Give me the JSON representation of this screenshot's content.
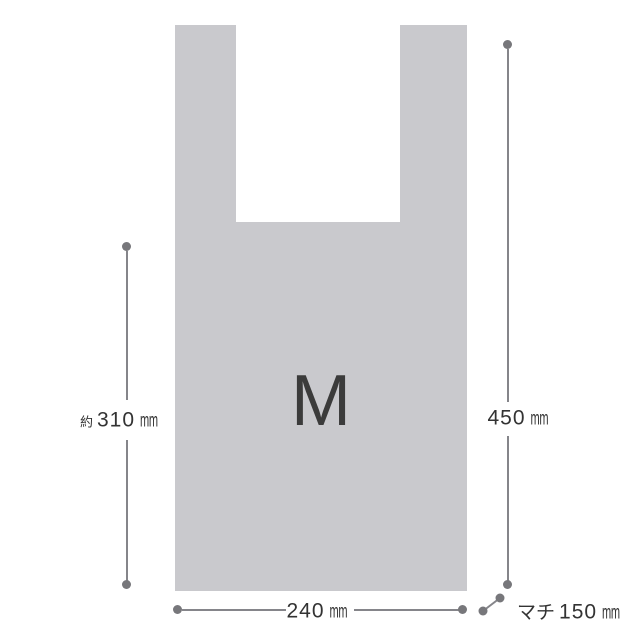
{
  "diagram": {
    "size_label": "M",
    "measurements": {
      "height_partial": {
        "prefix": "約",
        "value": "310",
        "unit": "mm"
      },
      "height_total": {
        "value": "450",
        "unit": "mm"
      },
      "width": {
        "value": "240",
        "unit": "mm"
      },
      "gusset": {
        "prefix": "マチ",
        "value": "150",
        "unit": "mm"
      }
    }
  },
  "colors": {
    "background": "#ffffff",
    "bag_fill": "#c9c9cd",
    "line": "#85858a",
    "dot": "#77777b",
    "label_text": "#333333",
    "size_text": "#3b3b3b"
  }
}
